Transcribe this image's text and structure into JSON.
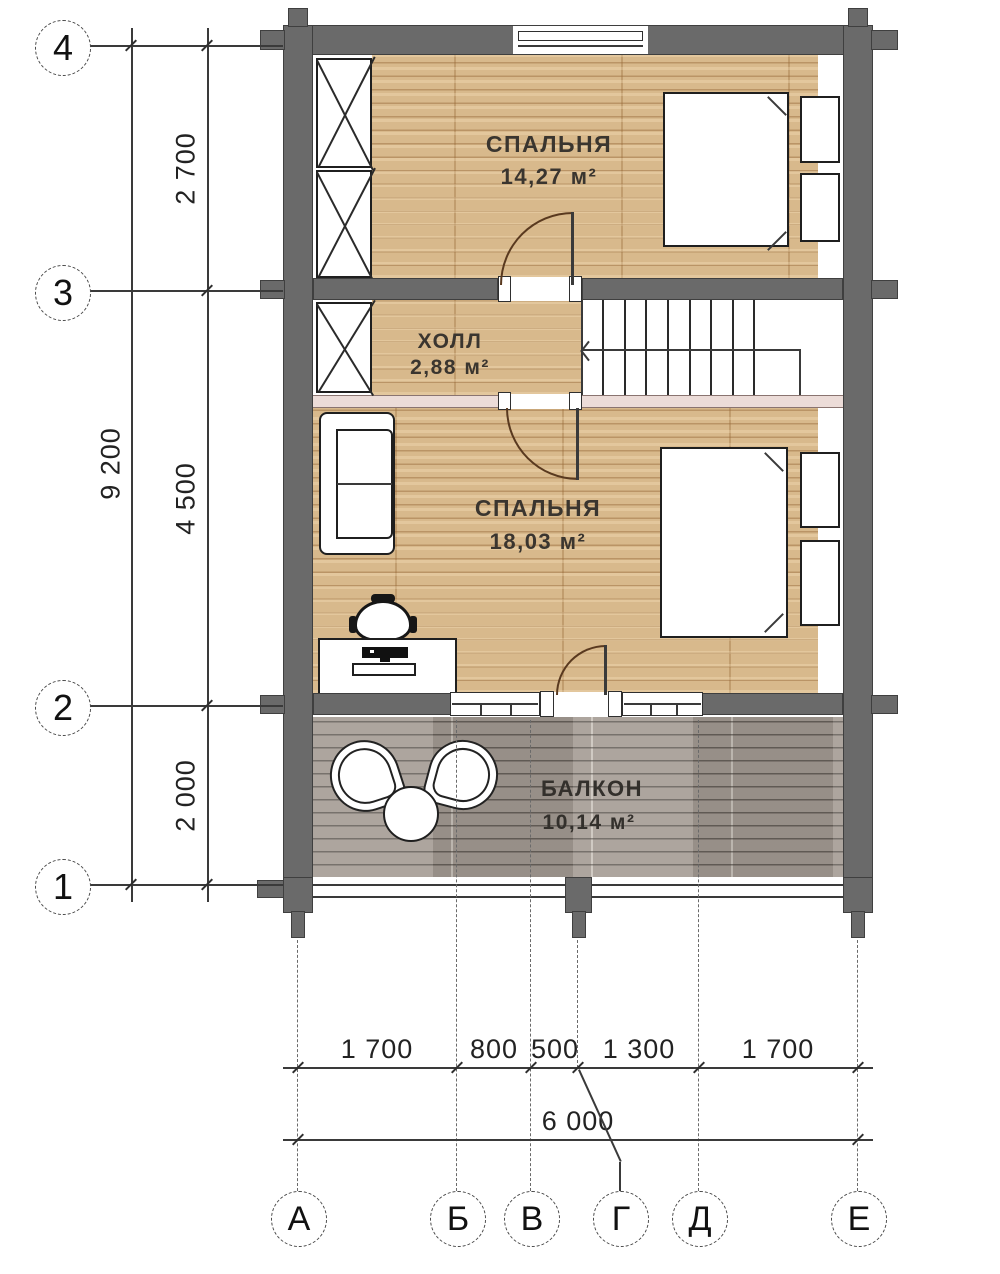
{
  "plan": {
    "rooms": [
      {
        "name": "СПАЛЬНЯ",
        "area": "14,27 м²"
      },
      {
        "name": "ХОЛЛ",
        "area": "2,88 м²"
      },
      {
        "name": "СПАЛЬНЯ",
        "area": "18,03 м²"
      },
      {
        "name": "БАЛКОН",
        "area": "10,14 м²"
      }
    ],
    "axes_vertical": [
      "4",
      "3",
      "2",
      "1"
    ],
    "axes_horizontal": [
      "А",
      "Б",
      "В",
      "Г",
      "Д",
      "Е"
    ],
    "dims_left": [
      "2 700",
      "4 500",
      "2 000"
    ],
    "dim_left_total": "9 200",
    "dims_bottom": [
      "1 700",
      "800",
      "500",
      "1 300",
      "1 700"
    ],
    "dim_bottom_total": "6 000",
    "colors": {
      "wall": "#6a6a6a",
      "floor_wood": "#d8b98c",
      "deck": "#a49b93",
      "partition": "#ecdcd8"
    }
  }
}
